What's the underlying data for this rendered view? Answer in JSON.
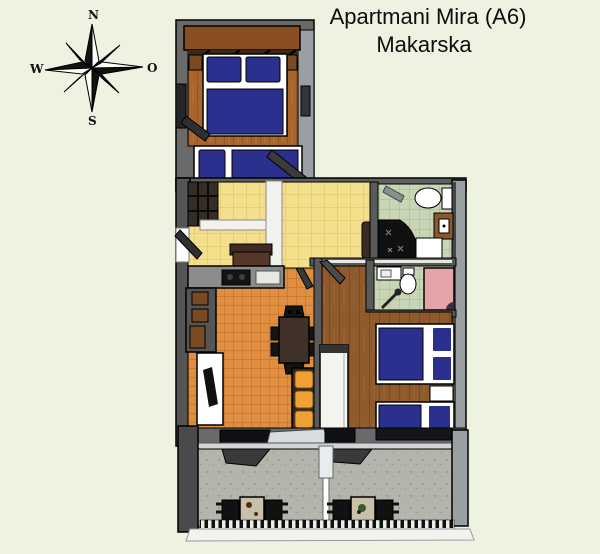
{
  "title": {
    "line1": "Apartmani Mira (A6)",
    "line2": "Makarska"
  },
  "compass": {
    "north": "N",
    "west": "W",
    "east": "O",
    "south": "S"
  },
  "palette": {
    "background": "#edf3e0",
    "wall_dark": "#555555",
    "wall_mid": "#6a6a6a",
    "wall_light": "#9aa0a2",
    "outline": "#000000",
    "wood_floor_bedroom1": "#a8662e",
    "wood_floor_bedroom2": "#8f5a2c",
    "hall_floor_yellow": "#f4df8d",
    "living_floor_orange": "#e08f42",
    "bathroom_floor_green": "#c9d6b6",
    "terrace_floor_gray": "#b4b4ac",
    "bed_blue": "#2b2f8e",
    "sofa_orange": "#f0a135",
    "shower_tray_pink": "#e4a4a8",
    "furniture_white": "#f4f4ef",
    "table_dark_brown": "#40302a",
    "wardrobe_brown": "#8a4e22"
  },
  "floor_plan": {
    "rooms": [
      {
        "name": "bedroom-1",
        "floor": "wood",
        "furniture": [
          "wardrobe",
          "double-bed",
          "single-bed",
          "window",
          "door"
        ]
      },
      {
        "name": "entry-hall",
        "floor": "yellow-tile",
        "furniture": [
          "entrance-door",
          "closet",
          "sofa-bench",
          "cabinet"
        ]
      },
      {
        "name": "bathroom-1",
        "floor": "green-tile",
        "furniture": [
          "toilet",
          "sink",
          "corner-shower",
          "shower-tray"
        ]
      },
      {
        "name": "bathroom-2",
        "floor": "green-tile",
        "furniture": [
          "sink",
          "toilet",
          "shower",
          "pink-shower-tray"
        ]
      },
      {
        "name": "living-kitchen",
        "floor": "orange-tile",
        "furniture": [
          "kitchen-counter",
          "stove",
          "dining-table",
          "chairs",
          "orange-sofa",
          "white-bench"
        ]
      },
      {
        "name": "bedroom-2",
        "floor": "wood",
        "furniture": [
          "white-wardrobe",
          "double-bed",
          "nightstand",
          "single-bed"
        ]
      },
      {
        "name": "terrace",
        "floor": "stone",
        "furniture": [
          "divider",
          "table-set-left",
          "table-set-right",
          "railing",
          "awnings"
        ]
      }
    ]
  }
}
